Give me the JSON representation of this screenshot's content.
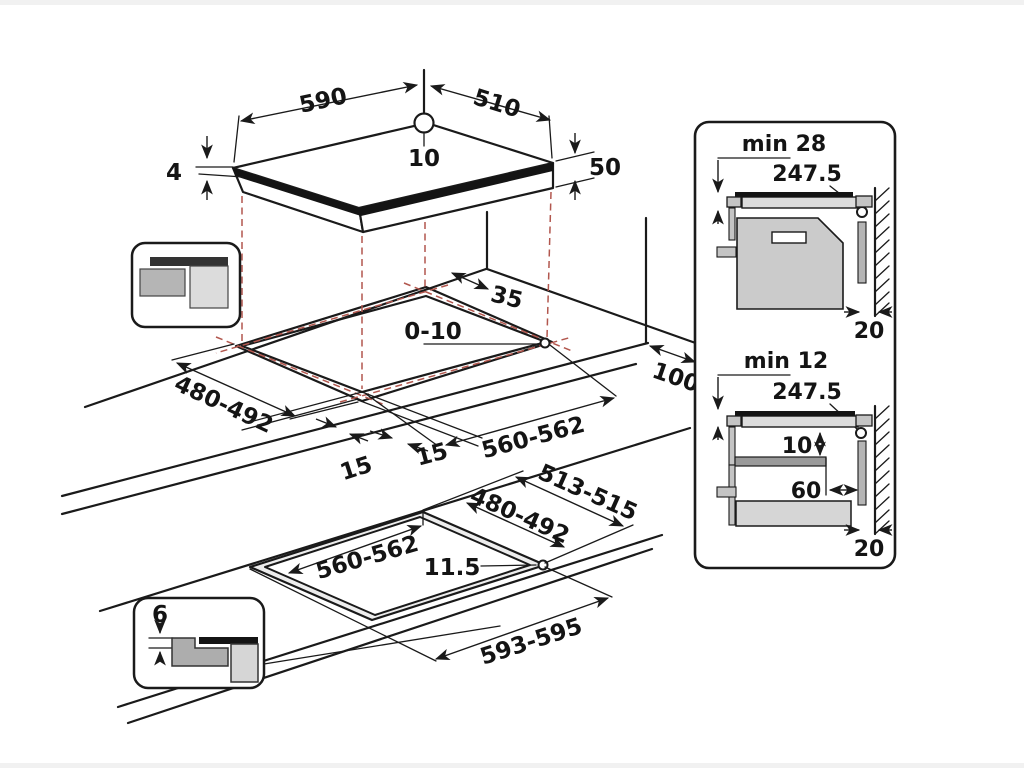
{
  "diagram": {
    "hob": {
      "width": "590",
      "depth": "510",
      "hole_offset": "10",
      "glass_thickness": "4",
      "edge_height": "50"
    },
    "cutout": {
      "corner_clearance": "35",
      "hole_range": "0-10",
      "depth": "480-492",
      "ledge_left": "15",
      "ledge_right": "15",
      "width": "560-562",
      "rear_clearance": "100"
    },
    "flush": {
      "outer_depth": "513-515",
      "inner_depth": "480-492",
      "inner_width": "560-562",
      "step": "11.5",
      "outer_width": "593-595",
      "rebate": "6"
    },
    "section_top": {
      "min_clearance": "min 28",
      "center_distance": "247.5",
      "wall_gap": "20"
    },
    "section_bottom": {
      "min_clearance": "min 12",
      "center_distance": "247.5",
      "shelf_gap": "10",
      "shelf_depth": "60",
      "wall_gap": "20"
    },
    "colors": {
      "line": "#1a1a1a",
      "projection_red": "#b2574e",
      "gray_medium": "#b5b5b5",
      "gray_light": "#d9d9d9",
      "bar_dark": "#141414"
    }
  }
}
